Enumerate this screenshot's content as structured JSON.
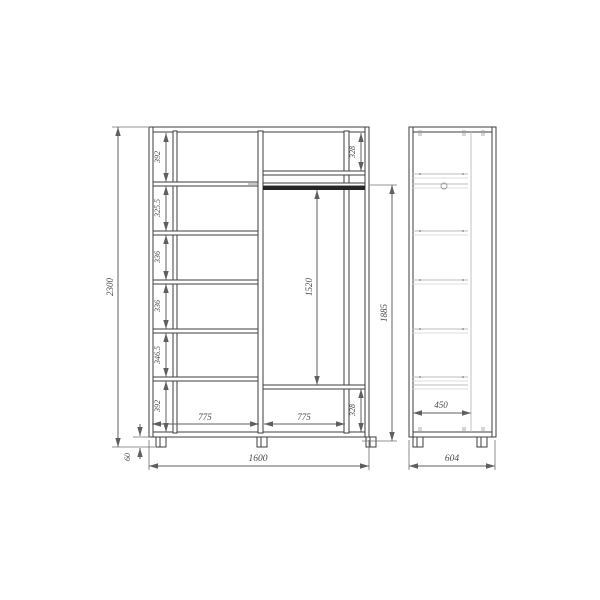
{
  "front_view": {
    "overall_height": "2300",
    "overall_width": "1600",
    "plinth_height": "60",
    "shelf_gaps": [
      "392",
      "325.5",
      "336",
      "336",
      "346.5",
      "392"
    ],
    "left_width": "775",
    "right_width": "775",
    "top_niche": "328",
    "bottom_niche": "328",
    "hanging_space": "1520",
    "right_niche_height": "1885"
  },
  "side_view": {
    "inner_depth": "450",
    "overall_depth": "604"
  },
  "colors": {
    "outline": "#3d3d3d",
    "dimension": "#5f5f5f",
    "hidden_line": "#bcbcbc",
    "rod": "#262626",
    "background": "#ffffff"
  }
}
